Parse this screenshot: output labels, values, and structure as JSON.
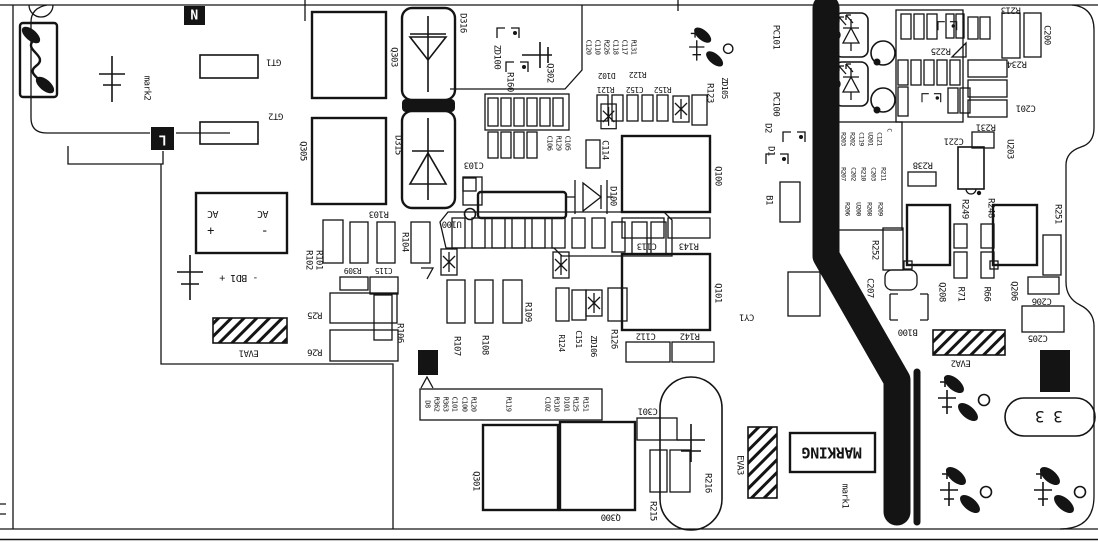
{
  "meta": {
    "document_type": "pcb-assembly-silkscreen-drawing",
    "canvas": {
      "width": 1098,
      "height": 542
    }
  },
  "colors": {
    "ink": "#141414",
    "background": "#ffffff"
  },
  "terminals": {
    "neutral": "N",
    "line": "L"
  },
  "fiducial_marks": [
    "mark1",
    "mark2"
  ],
  "keepout_areas": [
    "EVA1",
    "EVA2",
    "EVA3"
  ],
  "marking_box_text": "MARKING",
  "connector_text": "3 3",
  "ac_input": {
    "labels": [
      "AC",
      "AC"
    ],
    "polarity": [
      "+",
      "-"
    ],
    "bridge": "- BD1 +"
  },
  "silkscreen_labels": [
    {
      "t": "N",
      "x": 194,
      "y": 16,
      "r": 0,
      "fs": 13,
      "inv": true,
      "b": true
    },
    {
      "t": "L",
      "x": 163,
      "y": 139,
      "r": 180,
      "fs": 13,
      "inv": true,
      "b": true
    },
    {
      "t": "mark2",
      "x": 146,
      "y": 88,
      "r": 90
    },
    {
      "t": "GT1",
      "x": 274,
      "y": 61,
      "r": 180
    },
    {
      "t": "GT2",
      "x": 276,
      "y": 115,
      "r": 180
    },
    {
      "t": "Q303",
      "x": 393,
      "y": 57,
      "r": 90
    },
    {
      "t": "Q305",
      "x": 302,
      "y": 151,
      "r": 90
    },
    {
      "t": "D316",
      "x": 462,
      "y": 23,
      "r": 90
    },
    {
      "t": "D315",
      "x": 397,
      "y": 145,
      "r": 90
    },
    {
      "t": "ZD100",
      "x": 496,
      "y": 57,
      "r": 90
    },
    {
      "t": "R160",
      "x": 509,
      "y": 82,
      "r": 90
    },
    {
      "t": "Q302",
      "x": 549,
      "y": 73,
      "r": 90
    },
    {
      "t": "C103",
      "x": 474,
      "y": 164,
      "r": 180
    },
    {
      "t": "C106",
      "x": 549,
      "y": 143,
      "r": 90,
      "fs": 7
    },
    {
      "t": "R129",
      "x": 558,
      "y": 143,
      "r": 90,
      "fs": 7
    },
    {
      "t": "C105",
      "x": 567,
      "y": 143,
      "r": 90,
      "fs": 7
    },
    {
      "t": "C120",
      "x": 588,
      "y": 47,
      "r": 90,
      "fs": 7
    },
    {
      "t": "C110",
      "x": 597,
      "y": 47,
      "r": 90,
      "fs": 7
    },
    {
      "t": "R226",
      "x": 606,
      "y": 47,
      "r": 90,
      "fs": 7
    },
    {
      "t": "C118",
      "x": 615,
      "y": 47,
      "r": 90,
      "fs": 7
    },
    {
      "t": "C117",
      "x": 624,
      "y": 47,
      "r": 90,
      "fs": 7
    },
    {
      "t": "R131",
      "x": 633,
      "y": 47,
      "r": 90,
      "fs": 7
    },
    {
      "t": "D102",
      "x": 607,
      "y": 75,
      "r": 180,
      "fs": 8
    },
    {
      "t": "R122",
      "x": 638,
      "y": 74,
      "r": 180,
      "fs": 8
    },
    {
      "t": "R121",
      "x": 606,
      "y": 89,
      "r": 180,
      "fs": 8
    },
    {
      "t": "C152",
      "x": 635,
      "y": 89,
      "r": 180,
      "fs": 8
    },
    {
      "t": "R152",
      "x": 663,
      "y": 89,
      "r": 180,
      "fs": 8
    },
    {
      "t": "R123",
      "x": 709,
      "y": 93,
      "r": 90
    },
    {
      "t": "ZD105",
      "x": 724,
      "y": 88,
      "r": 90,
      "fs": 8
    },
    {
      "t": "PC101",
      "x": 775,
      "y": 37,
      "r": 90
    },
    {
      "t": "PC100",
      "x": 775,
      "y": 104,
      "r": 90
    },
    {
      "t": "D2",
      "x": 767,
      "y": 128,
      "r": 90
    },
    {
      "t": "D1",
      "x": 770,
      "y": 151,
      "r": 90
    },
    {
      "t": "C114",
      "x": 604,
      "y": 150,
      "r": 90
    },
    {
      "t": "D100",
      "x": 612,
      "y": 196,
      "r": 90
    },
    {
      "t": "U100",
      "x": 452,
      "y": 223,
      "r": 180
    },
    {
      "t": "R104",
      "x": 404,
      "y": 242,
      "r": 90
    },
    {
      "t": "R103",
      "x": 379,
      "y": 213,
      "r": 180
    },
    {
      "t": "R102",
      "x": 308,
      "y": 260,
      "r": 90
    },
    {
      "t": "R101",
      "x": 318,
      "y": 260,
      "r": 90
    },
    {
      "t": "R309",
      "x": 353,
      "y": 270,
      "r": 180,
      "fs": 8
    },
    {
      "t": "C115",
      "x": 384,
      "y": 270,
      "r": 180,
      "fs": 8
    },
    {
      "t": "R25",
      "x": 315,
      "y": 314,
      "r": 180
    },
    {
      "t": "R26",
      "x": 315,
      "y": 351,
      "r": 180
    },
    {
      "t": "EVA1",
      "x": 249,
      "y": 352,
      "r": 180
    },
    {
      "t": "R106",
      "x": 399,
      "y": 333,
      "r": 90
    },
    {
      "t": "R107",
      "x": 456,
      "y": 346,
      "r": 90
    },
    {
      "t": "R108",
      "x": 484,
      "y": 345,
      "r": 90
    },
    {
      "t": "R109",
      "x": 527,
      "y": 312,
      "r": 90
    },
    {
      "t": "R124",
      "x": 561,
      "y": 343,
      "r": 90,
      "fs": 8
    },
    {
      "t": "C151",
      "x": 578,
      "y": 339,
      "r": 90,
      "fs": 8
    },
    {
      "t": "ZD106",
      "x": 593,
      "y": 346,
      "r": 90,
      "fs": 8
    },
    {
      "t": "R126",
      "x": 613,
      "y": 339,
      "r": 90
    },
    {
      "t": "Q100",
      "x": 717,
      "y": 176,
      "r": 90
    },
    {
      "t": "C113",
      "x": 647,
      "y": 245,
      "r": 180
    },
    {
      "t": "R143",
      "x": 689,
      "y": 245,
      "r": 180
    },
    {
      "t": "Q101",
      "x": 717,
      "y": 293,
      "r": 90
    },
    {
      "t": "C112",
      "x": 646,
      "y": 335,
      "r": 180
    },
    {
      "t": "R142",
      "x": 690,
      "y": 335,
      "r": 180
    },
    {
      "t": "B1",
      "x": 768,
      "y": 200,
      "r": 90
    },
    {
      "t": "CY1",
      "x": 747,
      "y": 316,
      "r": 180
    },
    {
      "t": "Q301",
      "x": 475,
      "y": 481,
      "r": 90
    },
    {
      "t": "Q300",
      "x": 611,
      "y": 516,
      "r": 180
    },
    {
      "t": "C301",
      "x": 648,
      "y": 410,
      "r": 180
    },
    {
      "t": "R215",
      "x": 652,
      "y": 511,
      "r": 90
    },
    {
      "t": "R216",
      "x": 707,
      "y": 483,
      "r": 90
    },
    {
      "t": "EVA3",
      "x": 739,
      "y": 465,
      "r": 90
    },
    {
      "t": "MARKING",
      "x": 832,
      "y": 452,
      "r": 180,
      "fs": 15,
      "b": true
    },
    {
      "t": "mark1",
      "x": 844,
      "y": 496,
      "r": 90
    },
    {
      "t": "D8",
      "x": 427,
      "y": 404,
      "r": 90,
      "fs": 7
    },
    {
      "t": "R362",
      "x": 436,
      "y": 404,
      "r": 90,
      "fs": 7
    },
    {
      "t": "R363",
      "x": 445,
      "y": 404,
      "r": 90,
      "fs": 7
    },
    {
      "t": "C101",
      "x": 454,
      "y": 404,
      "r": 90,
      "fs": 7
    },
    {
      "t": "C100",
      "x": 464,
      "y": 404,
      "r": 90,
      "fs": 7
    },
    {
      "t": "R120",
      "x": 473,
      "y": 404,
      "r": 90,
      "fs": 7
    },
    {
      "t": "R119",
      "x": 508,
      "y": 404,
      "r": 90,
      "fs": 7
    },
    {
      "t": "C102",
      "x": 547,
      "y": 404,
      "r": 90,
      "fs": 7
    },
    {
      "t": "R310",
      "x": 556,
      "y": 404,
      "r": 90,
      "fs": 7
    },
    {
      "t": "D101",
      "x": 566,
      "y": 404,
      "r": 90,
      "fs": 7
    },
    {
      "t": "R125",
      "x": 575,
      "y": 404,
      "r": 90,
      "fs": 7
    },
    {
      "t": "R151",
      "x": 585,
      "y": 404,
      "r": 90,
      "fs": 7
    },
    {
      "t": "R252",
      "x": 874,
      "y": 250,
      "r": 90
    },
    {
      "t": "C207",
      "x": 869,
      "y": 288,
      "r": 90
    },
    {
      "t": "B100",
      "x": 908,
      "y": 331,
      "r": 180
    },
    {
      "t": "EVA2",
      "x": 961,
      "y": 362,
      "r": 180
    },
    {
      "t": "R203",
      "x": 843,
      "y": 139,
      "r": 90,
      "fs": 6.5
    },
    {
      "t": "R202",
      "x": 852,
      "y": 139,
      "r": 90,
      "fs": 6.5
    },
    {
      "t": "C119",
      "x": 861,
      "y": 139,
      "r": 90,
      "fs": 6.5
    },
    {
      "t": "U201",
      "x": 870,
      "y": 139,
      "r": 90,
      "fs": 6.5
    },
    {
      "t": "C121",
      "x": 879,
      "y": 139,
      "r": 90,
      "fs": 6.5
    },
    {
      "t": "C",
      "x": 889,
      "y": 130,
      "r": 90,
      "fs": 6.5
    },
    {
      "t": "R207",
      "x": 843,
      "y": 174,
      "r": 90,
      "fs": 6.5
    },
    {
      "t": "C202",
      "x": 853,
      "y": 174,
      "r": 90,
      "fs": 6.5
    },
    {
      "t": "R210",
      "x": 863,
      "y": 174,
      "r": 90,
      "fs": 6.5
    },
    {
      "t": "C203",
      "x": 873,
      "y": 174,
      "r": 90,
      "fs": 6.5
    },
    {
      "t": "R211",
      "x": 883,
      "y": 174,
      "r": 90,
      "fs": 6.5
    },
    {
      "t": "R206",
      "x": 847,
      "y": 209,
      "r": 90,
      "fs": 6.5
    },
    {
      "t": "U200",
      "x": 858,
      "y": 209,
      "r": 90,
      "fs": 6.5
    },
    {
      "t": "R208",
      "x": 869,
      "y": 209,
      "r": 90,
      "fs": 6.5
    },
    {
      "t": "R209",
      "x": 880,
      "y": 209,
      "r": 90,
      "fs": 6.5
    },
    {
      "t": "R238",
      "x": 923,
      "y": 164,
      "r": 180
    },
    {
      "t": "C221",
      "x": 954,
      "y": 140,
      "r": 180
    },
    {
      "t": "U203",
      "x": 1009,
      "y": 149,
      "r": 90
    },
    {
      "t": "R249",
      "x": 964,
      "y": 209,
      "r": 90
    },
    {
      "t": "R248",
      "x": 990,
      "y": 208,
      "r": 90
    },
    {
      "t": "R71",
      "x": 960,
      "y": 294,
      "r": 90
    },
    {
      "t": "R66",
      "x": 986,
      "y": 294,
      "r": 90
    },
    {
      "t": "Q208",
      "x": 941,
      "y": 292,
      "r": 90
    },
    {
      "t": "Q206",
      "x": 1013,
      "y": 291,
      "r": 90
    },
    {
      "t": "R251",
      "x": 1057,
      "y": 214,
      "r": 90
    },
    {
      "t": "C206",
      "x": 1042,
      "y": 300,
      "r": 180
    },
    {
      "t": "C205",
      "x": 1038,
      "y": 337,
      "r": 180
    },
    {
      "t": "R225",
      "x": 941,
      "y": 50,
      "r": 180
    },
    {
      "t": "R213",
      "x": 1011,
      "y": 9,
      "r": 180
    },
    {
      "t": "C200",
      "x": 1046,
      "y": 35,
      "r": 90
    },
    {
      "t": "R234",
      "x": 1017,
      "y": 63,
      "r": 180
    },
    {
      "t": "C201",
      "x": 1026,
      "y": 107,
      "r": 180
    },
    {
      "t": "R231",
      "x": 986,
      "y": 126,
      "r": 180
    },
    {
      "t": "3 3",
      "x": 1049,
      "y": 416,
      "r": 180,
      "fs": 16
    },
    {
      "t": "AC",
      "x": 213,
      "y": 213,
      "r": 180,
      "fs": 10
    },
    {
      "t": "+",
      "x": 211,
      "y": 231,
      "r": 180,
      "fs": 12
    },
    {
      "t": "AC",
      "x": 263,
      "y": 213,
      "r": 180,
      "fs": 10
    },
    {
      "t": "-",
      "x": 265,
      "y": 231,
      "r": 180,
      "fs": 13
    },
    {
      "t": "- BD1 +",
      "x": 239,
      "y": 277,
      "r": 180,
      "fs": 10
    }
  ]
}
